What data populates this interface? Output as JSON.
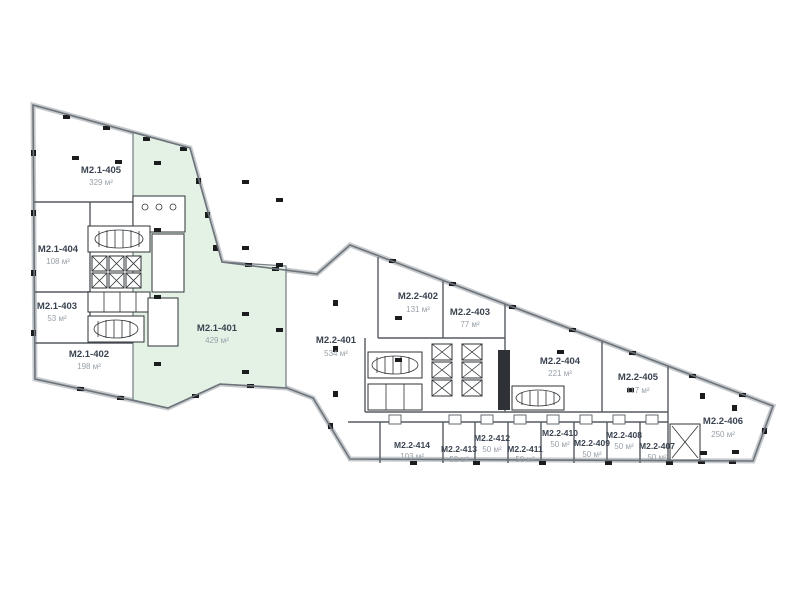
{
  "plan": {
    "selected_unit_id": "M2.1-401",
    "colors": {
      "selected_fill": "#e4f2e6",
      "outline_halo": "#c6cacd",
      "outline_line": "#6d737a",
      "name_text": "#3a4350",
      "area_text": "#98a0a8"
    },
    "units": [
      {
        "id": "M2.1-405",
        "area": "329 м²",
        "selected": false
      },
      {
        "id": "M2.1-404",
        "area": "108 м²",
        "selected": false
      },
      {
        "id": "M2.1-403",
        "area": "53 м²",
        "selected": false
      },
      {
        "id": "M2.1-402",
        "area": "198 м²",
        "selected": false
      },
      {
        "id": "M2.1-401",
        "area": "429 м²",
        "selected": true
      },
      {
        "id": "M2.2-401",
        "area": "534 м²",
        "selected": false
      },
      {
        "id": "M2.2-402",
        "area": "131 м²",
        "selected": false
      },
      {
        "id": "M2.2-403",
        "area": "77 м²",
        "selected": false
      },
      {
        "id": "M2.2-404",
        "area": "221 м²",
        "selected": false
      },
      {
        "id": "M2.2-405",
        "area": "117 м²",
        "selected": false
      },
      {
        "id": "M2.2-406",
        "area": "250 м²",
        "selected": false
      },
      {
        "id": "M2.2-414",
        "area": "103 м²",
        "selected": false
      },
      {
        "id": "M2.2-413",
        "area": "50 м²",
        "selected": false
      },
      {
        "id": "M2.2-412",
        "area": "50 м²",
        "selected": false
      },
      {
        "id": "M2.2-411",
        "area": "50 м²",
        "selected": false
      },
      {
        "id": "M2.2-410",
        "area": "50 м²",
        "selected": false
      },
      {
        "id": "M2.2-409",
        "area": "50 м²",
        "selected": false
      },
      {
        "id": "M2.2-408",
        "area": "50 м²",
        "selected": false
      },
      {
        "id": "M2.2-407",
        "area": "50 м²",
        "selected": false
      }
    ]
  }
}
